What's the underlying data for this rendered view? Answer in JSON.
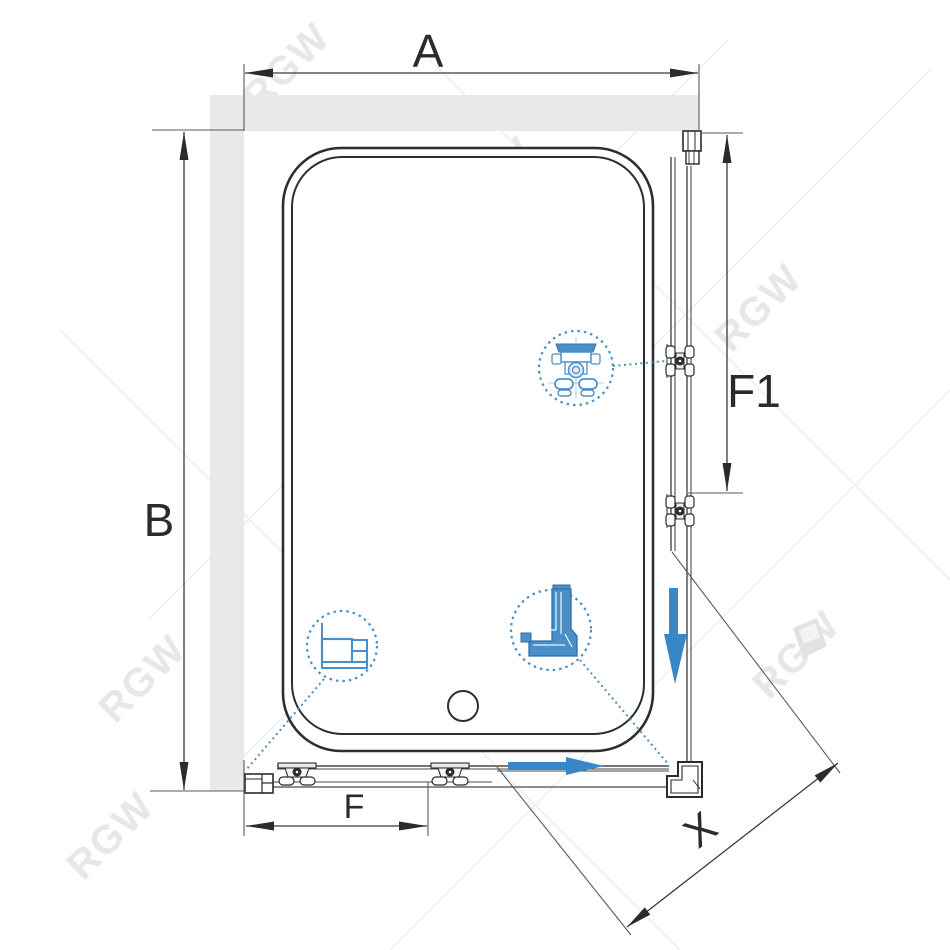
{
  "diagram": {
    "type": "shower-enclosure-top-view-schematic",
    "labels": {
      "width": "A",
      "depth": "B",
      "door_fixed_bottom": "F",
      "door_fixed_side": "F1",
      "entry_diagonal": "X"
    },
    "watermark": {
      "text": "RGW"
    },
    "colors": {
      "line_dark": "#2B2B2B",
      "wall_gray": "#E9E9E9",
      "accent_blue": "#3A87C8",
      "detail_blue": "#4A90C8",
      "watermark_gray": "#E7E7E7"
    },
    "callouts": [
      {
        "id": "roller-carriage-detail"
      },
      {
        "id": "wall-profile-section-detail"
      },
      {
        "id": "corner-connector-detail"
      }
    ],
    "arrows": [
      {
        "id": "door-slide-right"
      },
      {
        "id": "door-slide-down"
      }
    ]
  }
}
